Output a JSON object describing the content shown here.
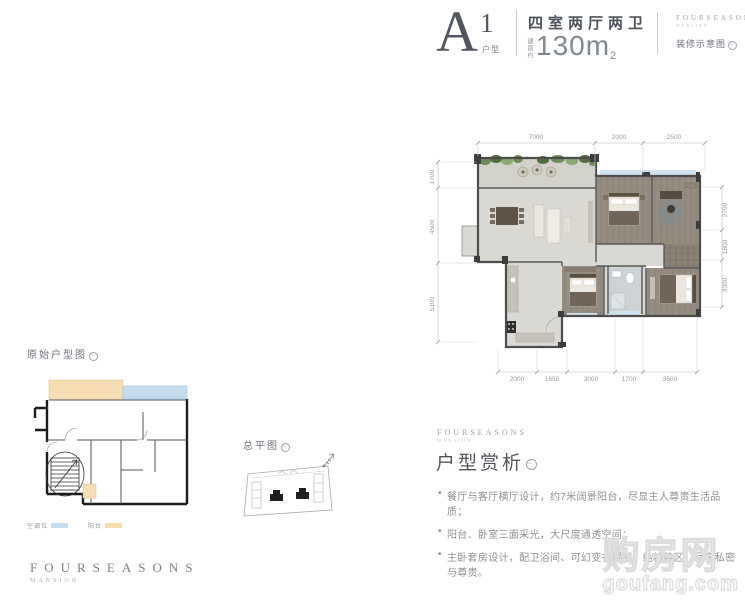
{
  "header": {
    "plan_letter": "A",
    "plan_number": "1",
    "plan_suffix": "户型",
    "rooms": "四室两厅两卫",
    "area_prefix": "建面约",
    "area_value": "130m",
    "area_sup": "2",
    "render_note": "装修示意图"
  },
  "brand": {
    "name": "FOURSEASONS",
    "sub": "MANSION"
  },
  "main_plan": {
    "dims_top": [
      "7000",
      "2000",
      "2500"
    ],
    "dims_left": [
      "1700",
      "4500",
      "5100"
    ],
    "dims_right": [
      "2700",
      "1800",
      "3300"
    ],
    "dims_bottom": [
      "2000",
      "1650",
      "3000",
      "1700",
      "3600"
    ]
  },
  "original_plan": {
    "label": "原始户型图",
    "legend": [
      {
        "label": "空调位",
        "color": "#c3ddef"
      },
      {
        "label": "阳台",
        "color": "#f6ddb4"
      }
    ]
  },
  "site_plan": {
    "label": "总平图"
  },
  "analysis": {
    "title": "户型赏析",
    "bullets": [
      "餐厅与客厅横厅设计，约7米阔景阳台，尽显主人尊贵生活品质；",
      "阳台、卧室三面采光，大尺度通透空间；",
      "主卧套房设计，配卫浴间、可幻变衣帽间，纯粹静区，尽享私密与尊贵。"
    ]
  },
  "watermark": {
    "line1": "购房网",
    "line2": "goufang.com"
  },
  "colors": {
    "wood_floor": "#968d81",
    "gray_floor": "#d9d8d3",
    "wall": "#4c4c4c",
    "window_blue": "#cfe2ee",
    "legend_blue": "#c3ddef",
    "legend_orange": "#f6ddb4",
    "plant_green": "#6e8b5a"
  }
}
